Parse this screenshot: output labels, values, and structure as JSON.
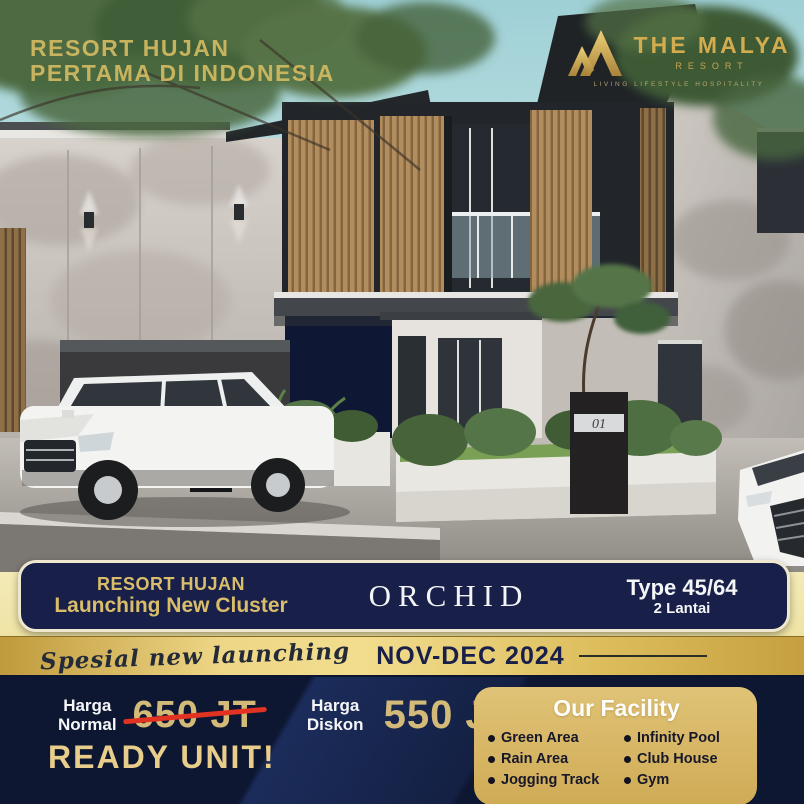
{
  "hero": {
    "headline_line1": "RESORT HUJAN",
    "headline_line2": "PERTAMA DI INDONESIA",
    "unit_number": "01",
    "logo": {
      "name": "THE MALYA",
      "subtitle": "RESORT",
      "tagline": "LIVING LIFESTYLE HOSPITALITY"
    }
  },
  "banner": {
    "left_line1": "RESORT HUJAN",
    "left_line2": "Launching New Cluster",
    "cluster_name": "ORCHID",
    "type_label": "Type 45/64",
    "floors_label": "2 Lantai"
  },
  "promo": {
    "script_text": "Spesial new launching",
    "period": "NOV-DEC 2024"
  },
  "pricing": {
    "normal_label_line1": "Harga",
    "normal_label_line2": "Normal",
    "normal_price": "650 JT",
    "discount_label_line1": "Harga",
    "discount_label_line2": "Diskon",
    "discount_price": "550 JT",
    "ready_text": "READY UNIT!"
  },
  "facility": {
    "title": "Our Facility",
    "items_left": [
      "Green Area",
      "Rain Area",
      "Jogging Track"
    ],
    "items_right": [
      "Infinity Pool",
      "Club House",
      "Gym"
    ]
  },
  "colors": {
    "navy_banner": "#18204a",
    "navy_bottom": "#0d1732",
    "gold_accent": "#d9bd6a",
    "gold_band": "#eed787",
    "cream_border": "#efe8cf",
    "price_gold": "#d3ba78",
    "strike_red": "#e23222",
    "facility_gold": "#d9bc6a",
    "sky": "#a5d4d8"
  }
}
